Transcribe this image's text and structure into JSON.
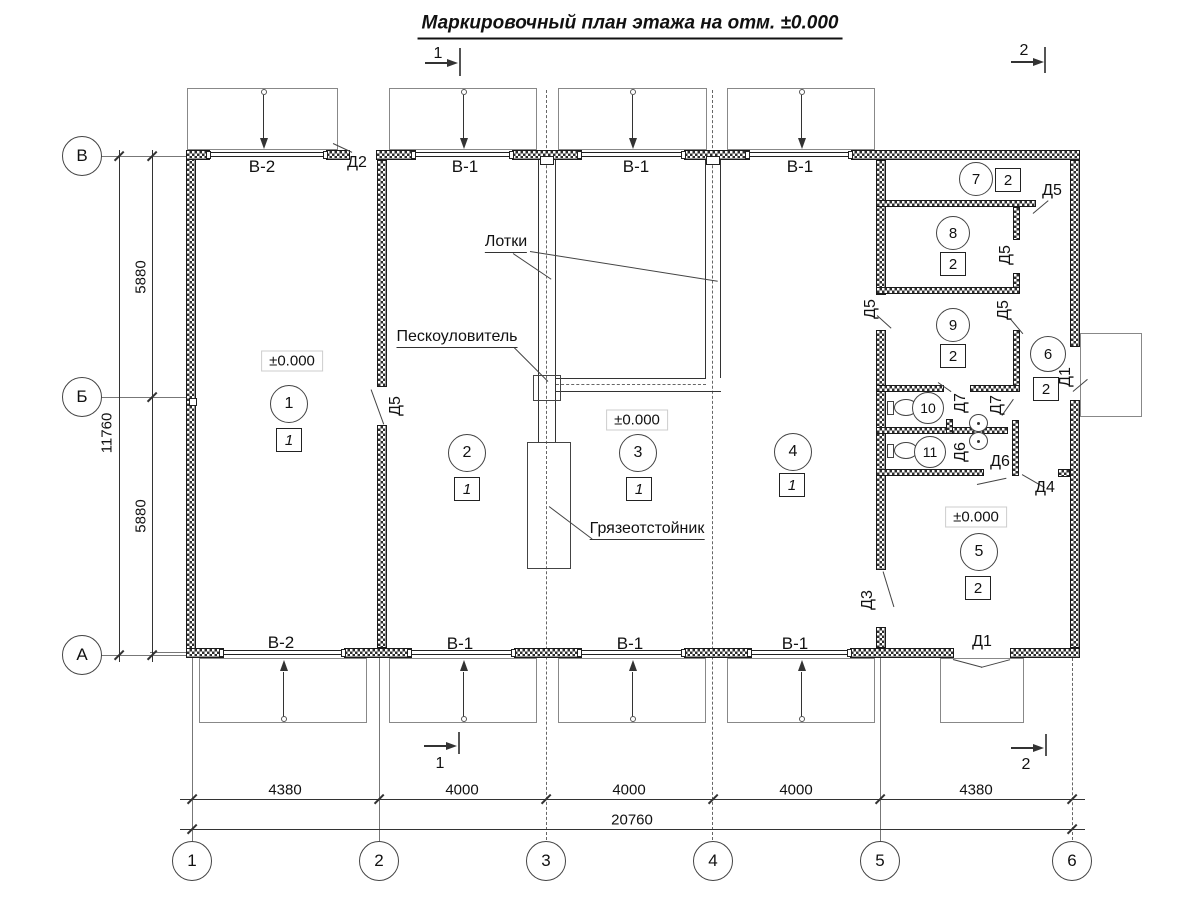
{
  "title": "Маркировочный план этажа на отм. ±0.000",
  "section_marks": {
    "s1": "1",
    "s2": "2"
  },
  "axis": {
    "rows": [
      "В",
      "Б",
      "А"
    ],
    "cols": [
      "1",
      "2",
      "3",
      "4",
      "5",
      "6"
    ]
  },
  "dimensions": {
    "spans": [
      "4380",
      "4000",
      "4000",
      "4000",
      "4380"
    ],
    "total": "20760",
    "heights": [
      "5880",
      "5880"
    ],
    "height_total": "11760"
  },
  "gates": {
    "top": [
      "В-2",
      "В-1",
      "В-1",
      "В-1"
    ],
    "bottom": [
      "В-2",
      "В-1",
      "В-1",
      "В-1"
    ]
  },
  "doors": {
    "d1": "Д1",
    "d2": "Д2",
    "d3": "Д3",
    "d4": "Д4",
    "d5": "Д5",
    "d6": "Д6",
    "d7": "Д7"
  },
  "rooms": [
    {
      "num": "1",
      "floor": "1"
    },
    {
      "num": "2",
      "floor": "1"
    },
    {
      "num": "3",
      "floor": "1"
    },
    {
      "num": "4",
      "floor": "1"
    },
    {
      "num": "5",
      "floor": "2"
    },
    {
      "num": "6",
      "floor": "2"
    },
    {
      "num": "7",
      "floor": "2"
    },
    {
      "num": "8",
      "floor": "2"
    },
    {
      "num": "9",
      "floor": "2"
    },
    {
      "num": "10",
      "floor": ""
    },
    {
      "num": "11",
      "floor": ""
    }
  ],
  "annotations": {
    "trays": "Лотки",
    "sand_trap": "Пескоуловитель",
    "mud_settler": "Грязеотстойник",
    "elevation": "±0.000"
  }
}
